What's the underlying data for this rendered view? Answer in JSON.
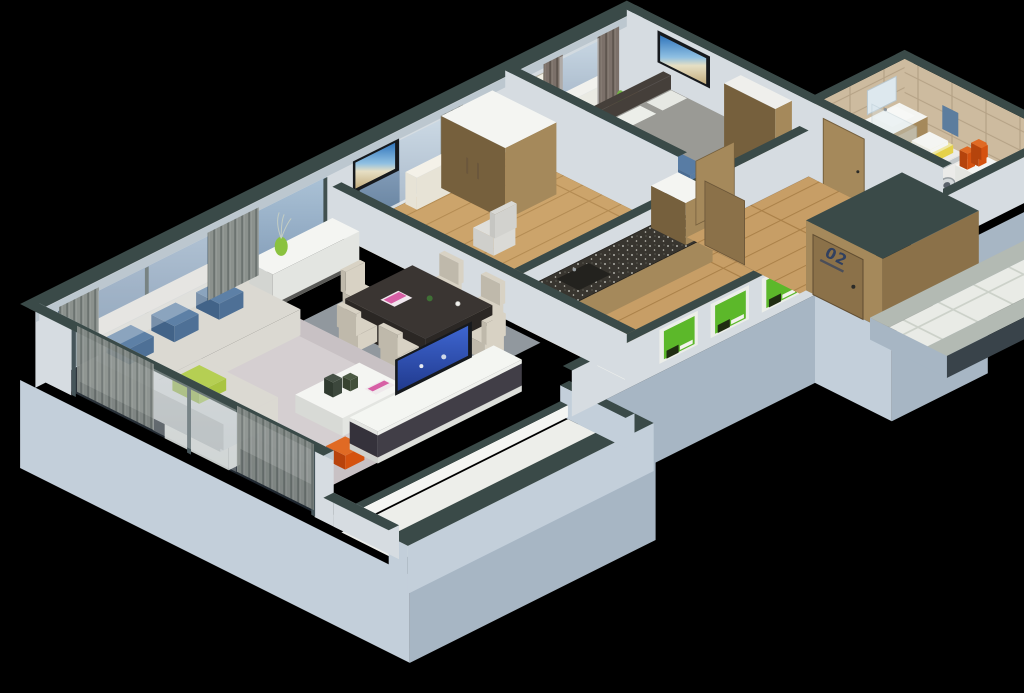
{
  "scene": {
    "type": "isometric-3d-apartment-floor-plan",
    "background": "#000000"
  },
  "labels": {
    "entrance_door": "02"
  },
  "palette": {
    "bg": "#000000",
    "wall_cap": "#3a4a48",
    "wall_light": "#d6dce1",
    "wall_mid": "#bcc7cf",
    "plinth_light": "#c3cfda",
    "plinth_mid": "#a7b6c4",
    "balcony_floor": "#edeeea",
    "floor_wood": "#c79e66",
    "floor_plank": "#aa8048",
    "tile_white": "#e9ebe6",
    "tile_grout": "#ccd1c9",
    "tile_border": "#b3bab3",
    "walk_edge": "#39434a",
    "tile_beige": "#cdbb9f",
    "tile_beige_grout": "#b5a286",
    "curtain_a": "#8b918d",
    "curtain_b": "#6c7370",
    "curtain_brown_a": "#7b7069",
    "curtain_brown_b": "#5f564f",
    "sheer": "#edf1f3",
    "sofa": "#dbd9d2",
    "sofa_shade": "#bdbbb3",
    "pillow_blue": "#4e7096",
    "pillow_green": "#a9c441",
    "rug_living": "#c8c1c4",
    "rug_living_light": "#d5cfd1",
    "rug_dining": "#99a0a6",
    "rug_bed": "#5a544b",
    "table_dark": "#3a3532",
    "table_side": "#2b2724",
    "chair_cream": "#d8d2c4",
    "chair_shade": "#bfb9ab",
    "white": "#f4f5f2",
    "off_white": "#e3e5e1",
    "media_dark": "#413e47",
    "tv_frame": "#16191d",
    "vase_green": "#8ac23f",
    "poster_green": "#5cb82a",
    "marble": "#38352f",
    "wood": "#a5895b",
    "wood_dark": "#8b7149",
    "wood_side": "#76603d",
    "bed_gray": "#9a9a95",
    "bed_blue": "#587ca4",
    "bed_frame": "#453f3a",
    "machine_white": "#ebebe9",
    "machine_shade": "#cfd2d2",
    "towel_yellow": "#e5d14b",
    "towel_blue": "#5c7d9e",
    "orange": "#d5520f",
    "radiator": "#e7e3d6",
    "painting_yellow": "#e9df93",
    "mirror": "#dde8ee",
    "door_number": "#31405f"
  },
  "rooms": [
    {
      "id": "living-room",
      "label": "Living room",
      "items": [
        "corner-sofa",
        "blue-cushions",
        "green-cushion",
        "coffee-table",
        "decor-vases",
        "magazine",
        "tv",
        "media-unit",
        "area-rug",
        "orange-poufs",
        "radiator",
        "window-curtains"
      ]
    },
    {
      "id": "dining-area",
      "label": "Dining area",
      "items": [
        "dark-dining-table",
        "six-cream-chairs",
        "pink-magazine",
        "flower-vase",
        "coffee-cup",
        "gray-rug",
        "sideboard",
        "green-vase"
      ]
    },
    {
      "id": "study",
      "label": "Study",
      "items": [
        "wall-tv-beach-scene",
        "office-chair",
        "wardrobe",
        "radiator",
        "sheer-curtains"
      ]
    },
    {
      "id": "kitchen",
      "label": "Kitchen",
      "items": [
        "marble-countertop",
        "sink",
        "tall-cabinet",
        "three-green-posters"
      ]
    },
    {
      "id": "bedroom",
      "label": "Bedroom",
      "items": [
        "double-bed",
        "blue-blanket",
        "white-pillows",
        "dark-rug",
        "yellow-wall-art",
        "wall-tv-beach-scene",
        "radiator",
        "brown-curtains",
        "wardrobe",
        "plant"
      ]
    },
    {
      "id": "bathroom",
      "label": "Bathroom",
      "items": [
        "washing-machine",
        "yellow-towels",
        "sink-vanity",
        "mirror",
        "shower-enclosure",
        "orange-canisters",
        "blue-towel",
        "beige-wall-tiles"
      ]
    },
    {
      "id": "entrance",
      "label": "Entrance",
      "door_label": "02",
      "items": [
        "wood-porch",
        "entry-door",
        "tiled-walkway"
      ]
    },
    {
      "id": "balcony",
      "label": "Balcony",
      "items": [
        "white-deck",
        "parapet"
      ]
    }
  ]
}
